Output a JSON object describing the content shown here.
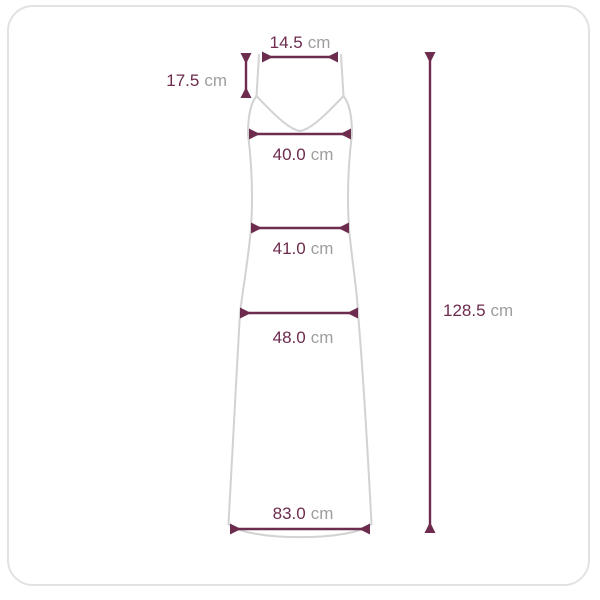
{
  "diagram_title": "dress-size-measurement-diagram",
  "colors": {
    "accent": "#6d2b4e",
    "unit_text": "#9e9e9e",
    "garment_outline": "#d2d2d2",
    "card_border": "#e2e2e2",
    "background": "#ffffff"
  },
  "measurements": {
    "top_width": {
      "value": "14.5",
      "unit": "cm"
    },
    "strap_length": {
      "value": "17.5",
      "unit": "cm"
    },
    "bust_width": {
      "value": "40.0",
      "unit": "cm"
    },
    "waist_width": {
      "value": "41.0",
      "unit": "cm"
    },
    "hip_width": {
      "value": "48.0",
      "unit": "cm"
    },
    "hem_width": {
      "value": "83.0",
      "unit": "cm"
    },
    "total_length": {
      "value": "128.5",
      "unit": "cm"
    }
  }
}
